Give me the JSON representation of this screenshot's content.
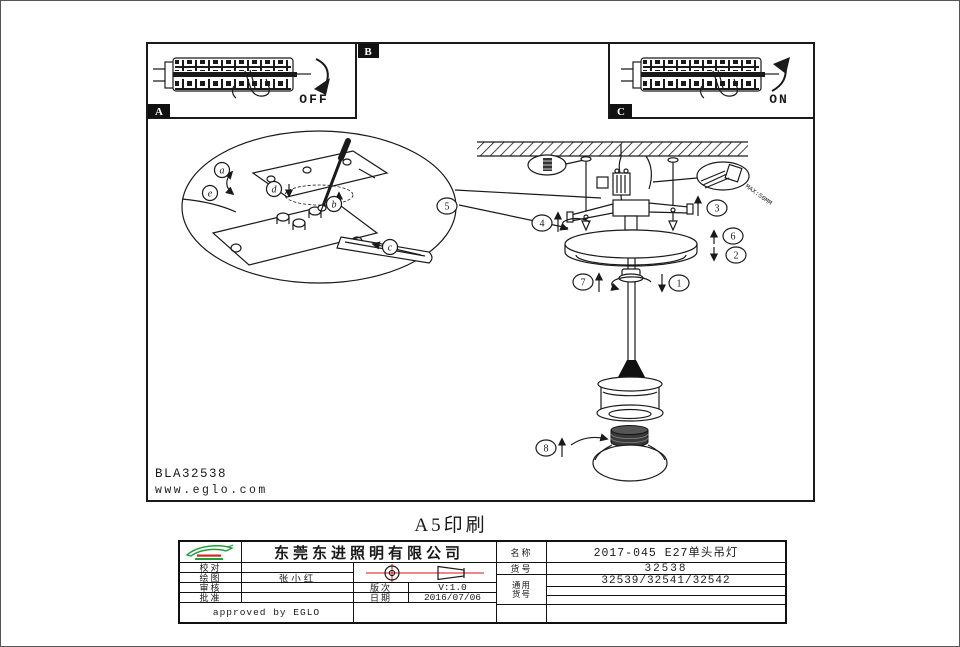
{
  "page": {
    "print_note": "A5印刷",
    "drawing_code": "BLA32538",
    "website": "www.eglo.com"
  },
  "panels": {
    "a_tag": "A",
    "b_tag": "B",
    "c_tag": "C",
    "off_label": "OFF",
    "on_label": "ON"
  },
  "detail_labels": {
    "a": "a",
    "b": "b",
    "c": "c",
    "d": "d",
    "e": "e"
  },
  "steps": {
    "s1": "1",
    "s2": "2",
    "s3": "3",
    "s4": "4",
    "s5": "5",
    "s6": "6",
    "s7": "7",
    "s8": "8"
  },
  "notes": {
    "max_wire": "MAX:50MM"
  },
  "title_block": {
    "company": "东莞东进照明有限公司",
    "sign_rows": [
      {
        "label": "校对",
        "value": ""
      },
      {
        "label": "绘图",
        "value": "张小红"
      },
      {
        "label": "审核",
        "value": ""
      },
      {
        "label": "批准",
        "value": ""
      }
    ],
    "approved": "approved by EGLO",
    "revision_label": "版次",
    "revision": "V:1.0",
    "date_label": "日期",
    "date": "2016/07/06",
    "name_label": "名称",
    "product_name": "2017-045 E27单头吊灯",
    "sku_label": "货号",
    "sku": "32538",
    "generic_label_1": "通用",
    "generic_label_2": "货号",
    "generic_skus": "32539/32541/32542"
  },
  "colors": {
    "line": "#1a1a1a",
    "accent_red": "#dd1111",
    "logo_green": "#1fa03c",
    "logo_red": "#cc2a1e"
  }
}
